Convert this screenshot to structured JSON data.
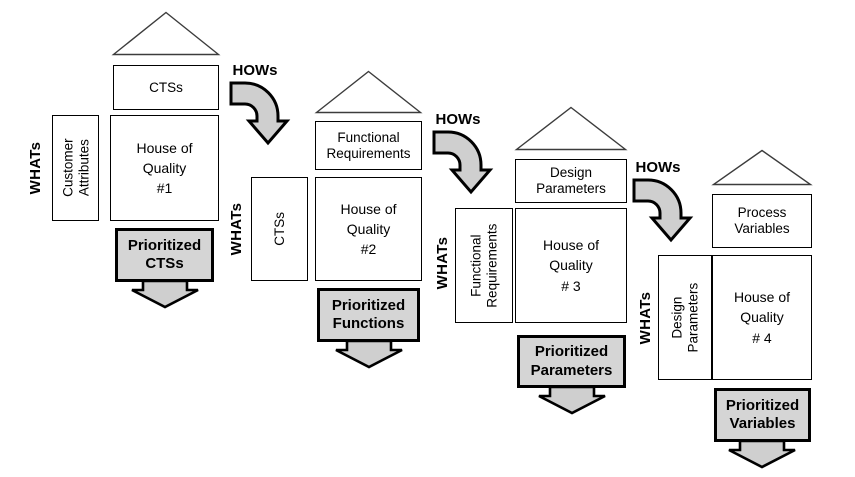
{
  "diagram": {
    "colors": {
      "background": "#ffffff",
      "outline": "#000000",
      "box_shade": "#d5d5d5",
      "arrow_shade": "#cfcfcf"
    },
    "houses": [
      {
        "top_label": "CTSs",
        "whats_label": "WHATs",
        "left_label": "Customer\nAttributes",
        "main_label": "House of\nQuality\n#1",
        "prioritized_label": "Prioritized\nCTSs"
      },
      {
        "top_label": "Functional\nRequirements",
        "whats_label": "WHATs",
        "left_label": "CTSs",
        "main_label": "House of\nQuality\n#2",
        "prioritized_label": "Prioritized\nFunctions"
      },
      {
        "top_label": "Design\nParameters",
        "whats_label": "WHATs",
        "left_label": "Functional\nRequirements",
        "main_label": "House of\nQuality\n# 3",
        "prioritized_label": "Prioritized\nParameters"
      },
      {
        "top_label": "Process\nVariables",
        "whats_label": "WHATs",
        "left_label": "Design\nParameters",
        "main_label": "House of\nQuality\n# 4",
        "prioritized_label": "Prioritized\nVariables"
      }
    ],
    "connectors": [
      {
        "label": "HOWs"
      },
      {
        "label": "HOWs"
      },
      {
        "label": "HOWs"
      }
    ]
  }
}
